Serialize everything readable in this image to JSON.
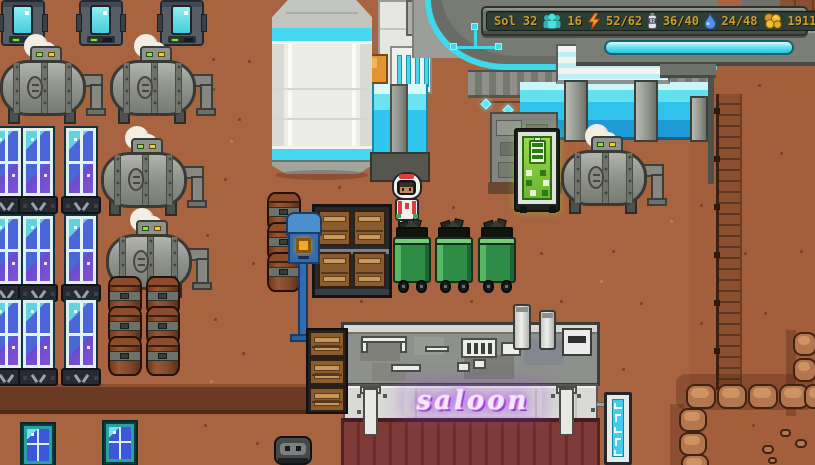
{
  "hud": {
    "sol": "Sol 32",
    "oxygen_icon_label": "O2",
    "stats": [
      {
        "name": "colonists",
        "icon": "colonists-icon",
        "value": "16",
        "color": "#49e2df"
      },
      {
        "name": "energy",
        "icon": "energy-bolt-icon",
        "value": "52/62",
        "color": "#f59b1e"
      },
      {
        "name": "oxygen",
        "icon": "oxygen-tank-icon",
        "value": "36/40",
        "color": "#dfe4ee"
      },
      {
        "name": "water",
        "icon": "water-drop-icon",
        "value": "24/48",
        "color": "#4f8fe8"
      },
      {
        "name": "credits",
        "icon": "coins-icon",
        "value": "1911g",
        "color": "#f2c12e"
      }
    ],
    "text_color": "#cf9a2a",
    "bar_bg": "#2d3e36",
    "frame_color": "#70736c"
  },
  "signs": {
    "saloon": {
      "text": "saloon",
      "neon_color": "#c45ef6"
    },
    "charging_kiosk": {
      "icon": "battery-icon",
      "screen_color": "#7cc838"
    },
    "vertical_shop_sign": {
      "icon": "alien-glyphs-icon",
      "panel_color": "#44ccf0"
    }
  },
  "scene": {
    "ground_color": "#a86340",
    "colors": {
      "cliff_ledge": "#6a3a25",
      "solar_panel_glass": "#4a66d8",
      "tank_body": "#92948e",
      "compost_bin_green": "#2f8c46",
      "saloon_awning": "#7e3b37",
      "dome_trim": "#3ed9ea",
      "aqua_glass": "#2fc2ea",
      "rock": "#b3764e",
      "machine_screen": "#5cd8e6",
      "mailbox_blue": "#2f6cb0",
      "barrel_rust": "#8e4a2a"
    }
  }
}
